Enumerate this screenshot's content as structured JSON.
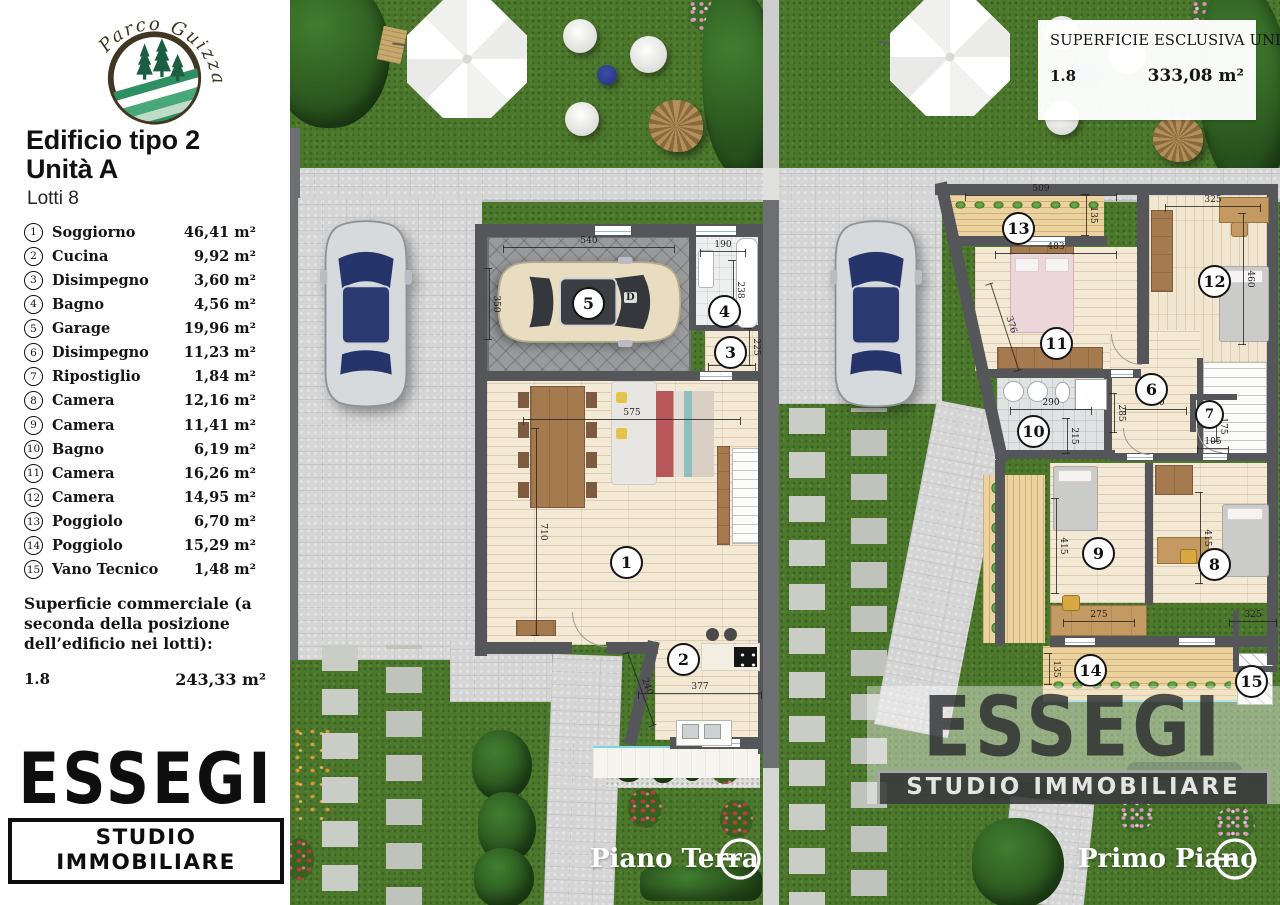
{
  "sidebar": {
    "logo_text": "Parco Guizza",
    "title_line1": "Edificio tipo 2",
    "title_line2": "Unità A",
    "subtitle": "Lotti 8",
    "commercial_label": "Superficie commerciale (a seconda della posizione dell’edificio nei lotti):",
    "commercial_lot": "1.8",
    "commercial_value": "243,33 m²"
  },
  "rooms": [
    {
      "num": "1",
      "name": "Soggiorno",
      "area": "46,41 m²"
    },
    {
      "num": "2",
      "name": "Cucina",
      "area": "9,92 m²"
    },
    {
      "num": "3",
      "name": "Disimpegno",
      "area": "3,60 m²"
    },
    {
      "num": "4",
      "name": "Bagno",
      "area": "4,56 m²"
    },
    {
      "num": "5",
      "name": "Garage",
      "area": "19,96 m²"
    },
    {
      "num": "6",
      "name": "Disimpegno",
      "area": "11,23 m²"
    },
    {
      "num": "7",
      "name": "Ripostiglio",
      "area": "1,84 m²"
    },
    {
      "num": "8",
      "name": "Camera",
      "area": "12,16 m²"
    },
    {
      "num": "9",
      "name": "Camera",
      "area": "11,41 m²"
    },
    {
      "num": "10",
      "name": "Bagno",
      "area": "6,19 m²"
    },
    {
      "num": "11",
      "name": "Camera",
      "area": "16,26 m²"
    },
    {
      "num": "12",
      "name": "Camera",
      "area": "14,95 m²"
    },
    {
      "num": "13",
      "name": "Poggiolo",
      "area": "6,70 m²"
    },
    {
      "num": "14",
      "name": "Poggiolo",
      "area": "15,29 m²"
    },
    {
      "num": "15",
      "name": "Vano Tecnico",
      "area": "1,48 m²"
    }
  ],
  "exclusive_box": {
    "title": "SUPERFICIE ESCLUSIVA UNITÀ A",
    "lot": "1.8",
    "value": "333,08 m²"
  },
  "branding": {
    "name": "ESSEGI",
    "tagline": "STUDIO IMMOBILIARE"
  },
  "floor_labels": {
    "ground": "Piano Terra",
    "first": "Primo Piano"
  },
  "plan_dims": {
    "ground": [
      "540",
      "350",
      "190",
      "238",
      "225",
      "160",
      "575",
      "710",
      "240",
      "377"
    ],
    "first": [
      "509",
      "135",
      "483",
      "376",
      "325",
      "460",
      "290",
      "215",
      "285",
      "210",
      "175",
      "105",
      "415",
      "275",
      "415",
      "325",
      "135"
    ]
  },
  "car_badge": "D",
  "colors": {
    "grass": "#4c782c",
    "wall": "#55565a",
    "wood_floor": "#f3e9d5",
    "balcony_wood": "#ecd29e",
    "paving": "#d4d5d4",
    "logo_green": "#2e8f62",
    "logo_brown": "#423522",
    "glass_blue": "#25356b",
    "accent_cyan": "#7fd4e8"
  }
}
